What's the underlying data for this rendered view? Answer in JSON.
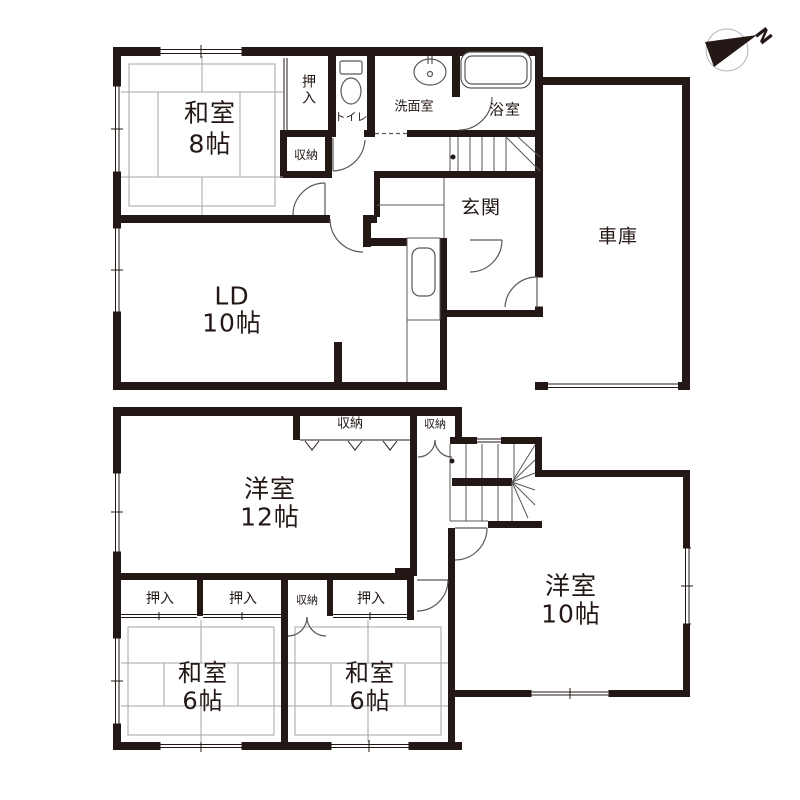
{
  "colors": {
    "wall": "#231815",
    "line": "#595757",
    "tatami": "#a6a6a6"
  },
  "compass": {
    "label": "N"
  },
  "floor1": {
    "washitsu8": {
      "name": "和室",
      "size": "8帖"
    },
    "oshiire": "押入",
    "closet": "収納",
    "toilet": "トイレ",
    "washroom": "洗面室",
    "bathroom": "浴室",
    "entrance": "玄関",
    "garage": "車庫",
    "living": {
      "name": "LD",
      "size": "10帖"
    }
  },
  "floor2": {
    "closet_top": "収納",
    "closet_top_small": "収納",
    "western12": {
      "name": "洋室",
      "size": "12帖"
    },
    "oshiire_left": "押入",
    "oshiire_mid": "押入",
    "closet_row": "収納",
    "oshiire_right": "押入",
    "washitsu_left": {
      "name": "和室",
      "size": "6帖"
    },
    "washitsu_right": {
      "name": "和室",
      "size": "6帖"
    },
    "western10": {
      "name": "洋室",
      "size": "10帖"
    }
  }
}
